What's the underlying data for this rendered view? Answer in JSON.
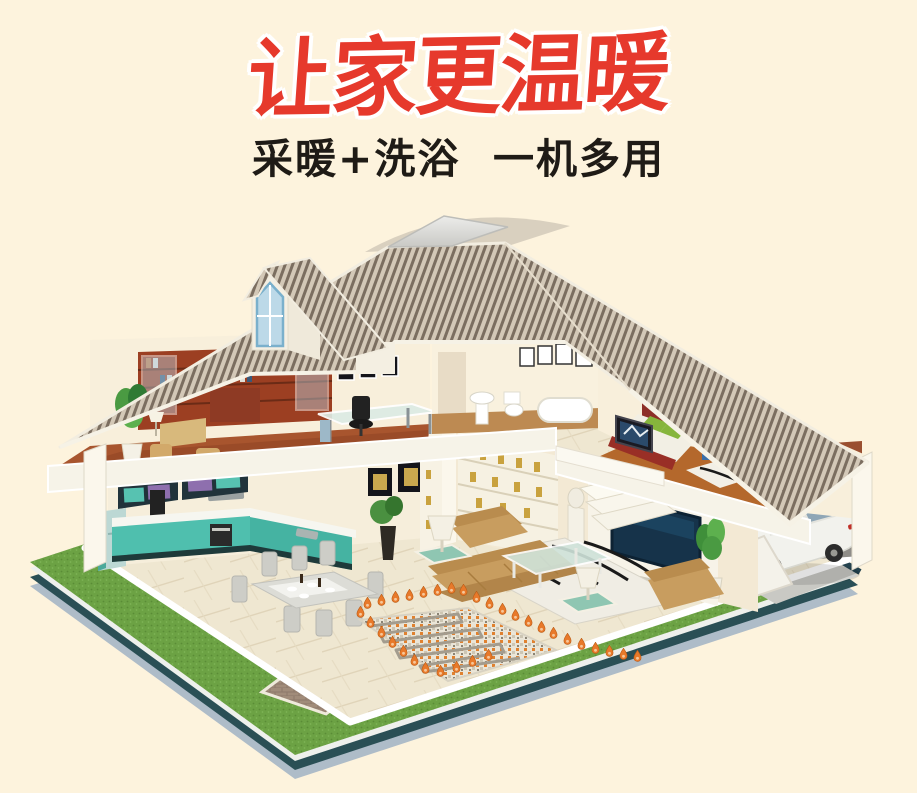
{
  "page": {
    "background": "#fdf3dd"
  },
  "header": {
    "title": "让家更温暖",
    "subtitle": "采暖+洗浴  一机多用"
  },
  "colors": {
    "title_red": "#e6392c",
    "subtitle_black": "#1f1b16",
    "roof_tile_dark": "#7b6e60",
    "roof_tile_light": "#d3c8b7",
    "grass_green": "#6ca244",
    "curb_teal": "#2a4f55",
    "curb_gray": "#aebcc8",
    "floor_tile_cream": "#efe7d1",
    "study_floor_red": "#a8552e",
    "bedroom_floor_orange": "#b4682c",
    "kitchen_teal": "#4fbfae",
    "sofa_tan": "#c89d5f",
    "tv_screen_navy": "#16334a",
    "heat_flame_orange": "#e8792a",
    "car_white": "#f2f2ed"
  },
  "illustration": {
    "elements": [
      "hipped-tile-roof",
      "dormer-window",
      "study-room",
      "bookshelf",
      "office-desk",
      "bathroom",
      "pedestal-sink",
      "toilet",
      "bathtub",
      "bedroom",
      "double-bed",
      "kitchen-cabinets",
      "refrigerator",
      "dining-table",
      "living-room-sofa",
      "coffee-table",
      "display-shelf",
      "television-wall",
      "underfloor-heating-mat",
      "heat-arrows",
      "white-sedan-car",
      "lawn",
      "brick-path"
    ]
  }
}
